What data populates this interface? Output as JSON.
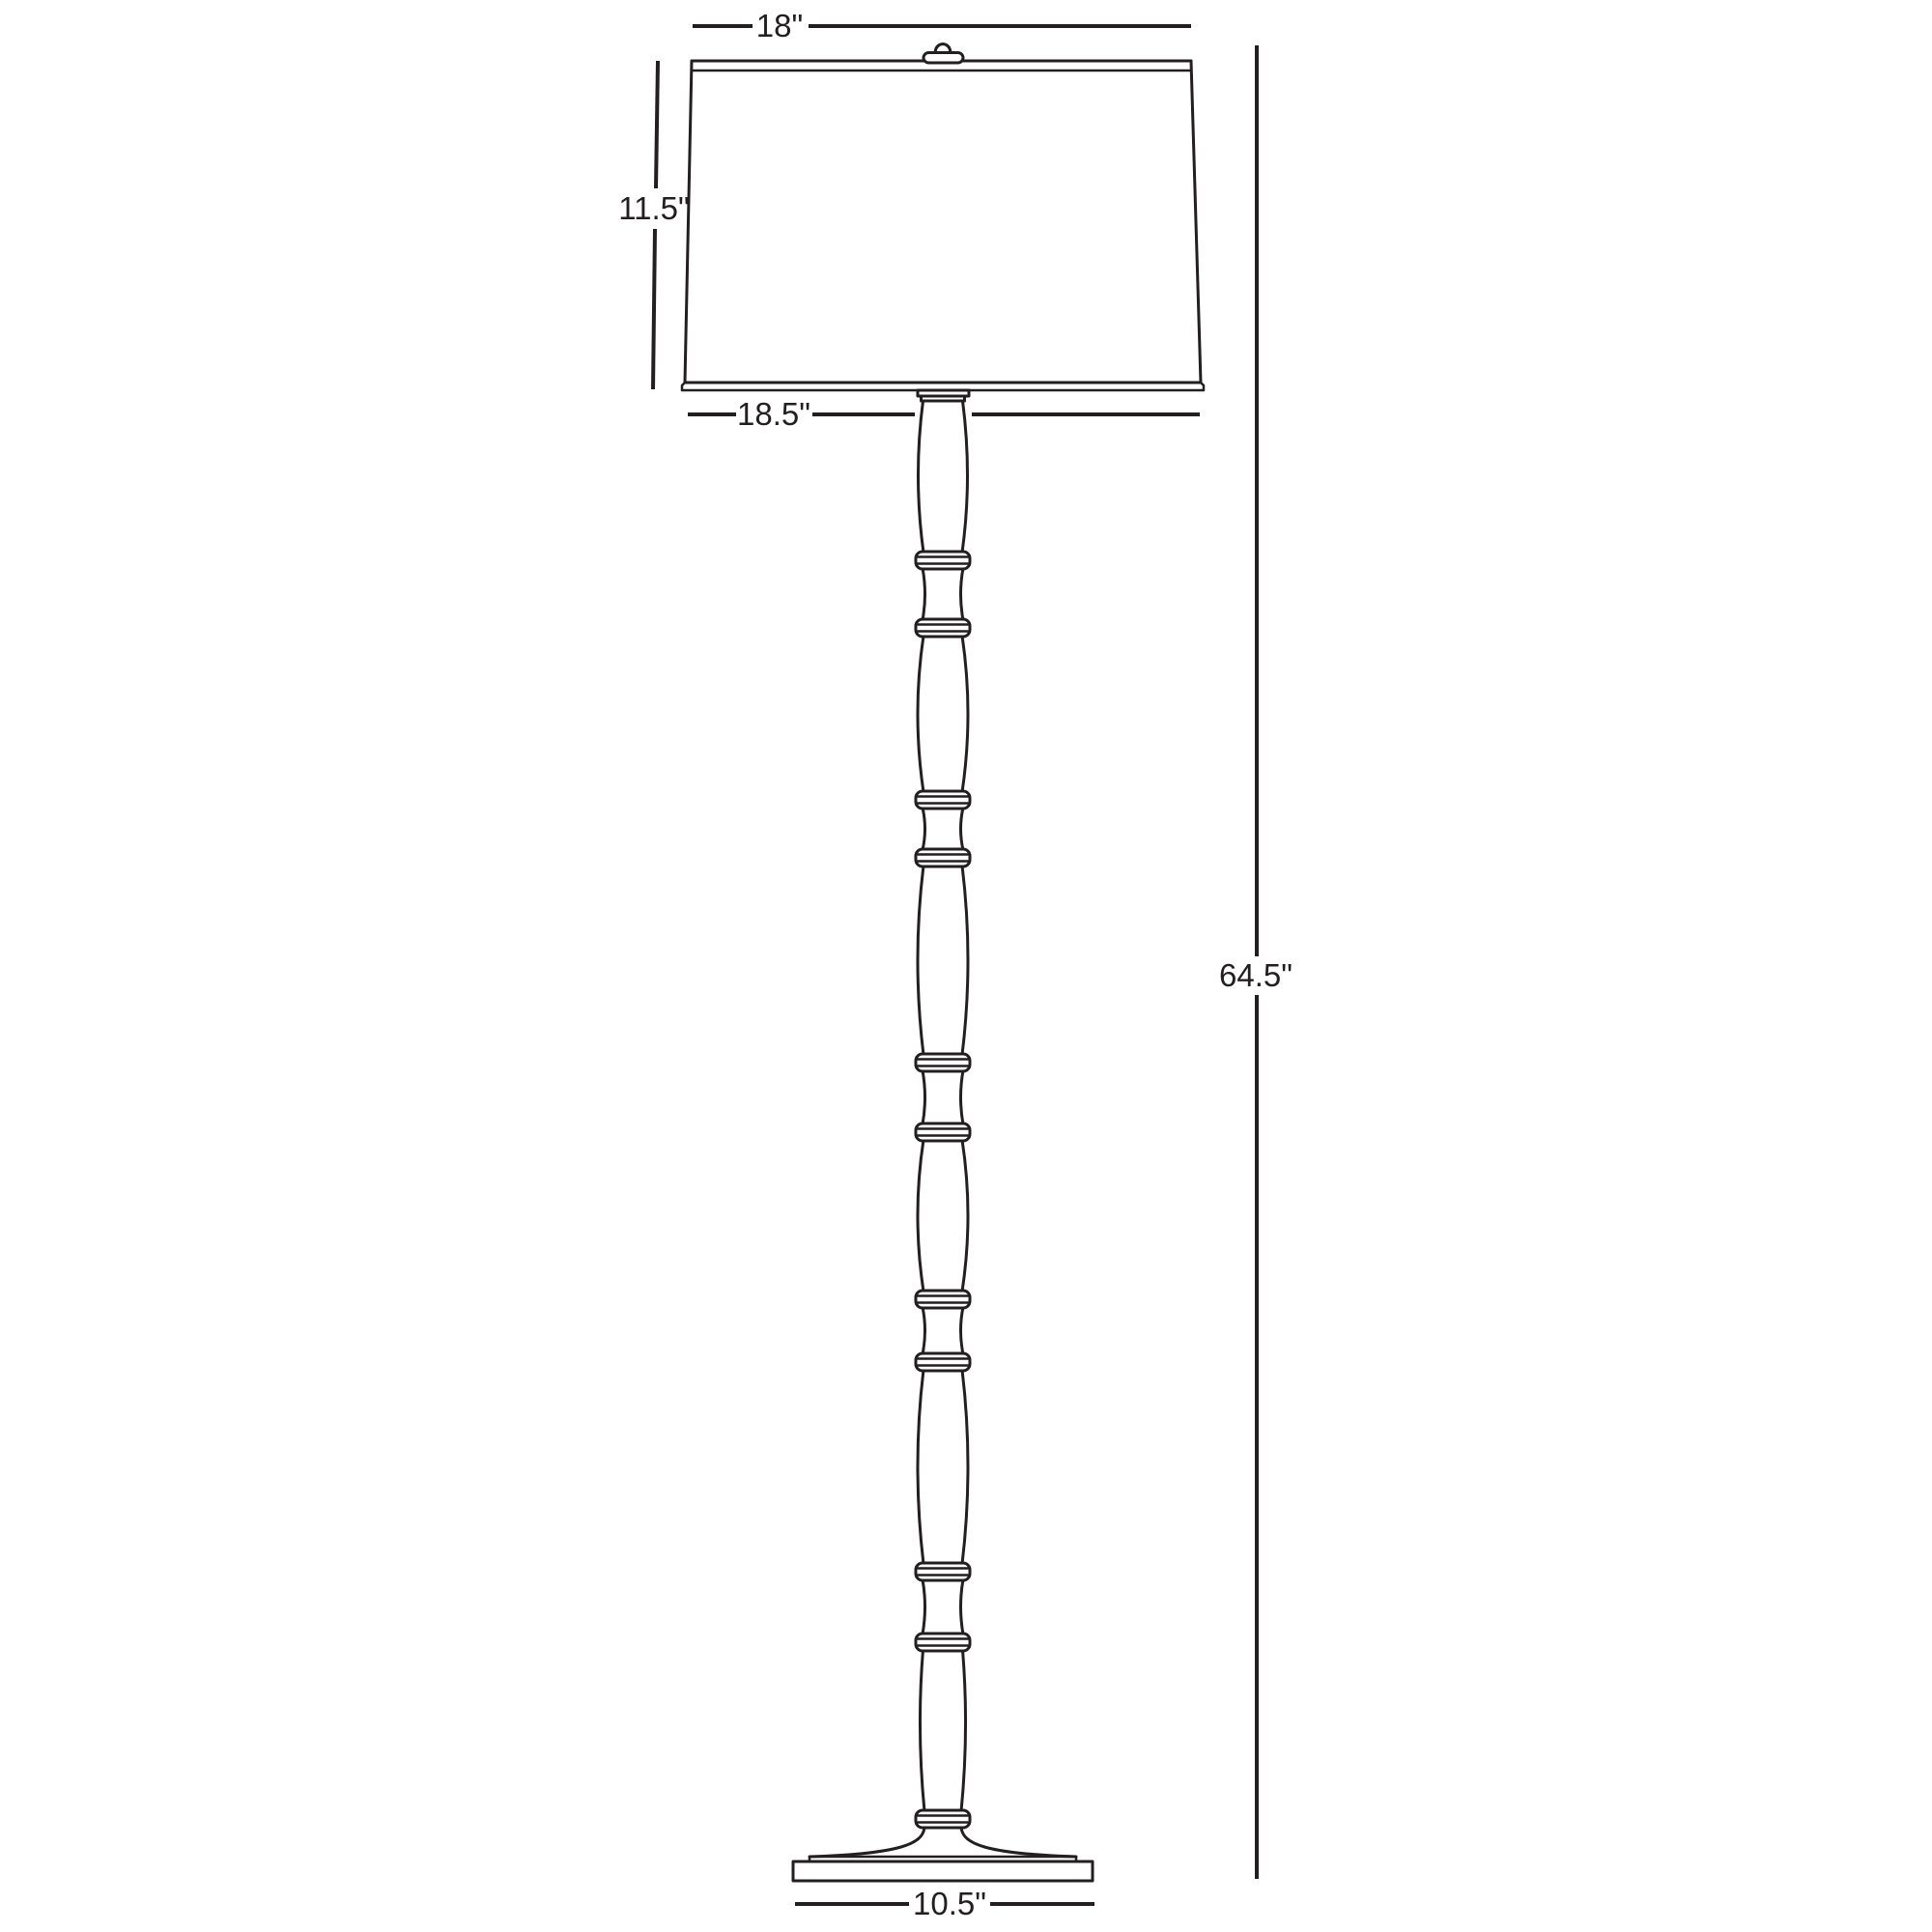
{
  "diagram": {
    "title": "Floor lamp dimension drawing",
    "background_color": "#ffffff",
    "line_color": "#231f20",
    "labels": {
      "shade_top_width": "18\"",
      "shade_height": "11.5\"",
      "shade_bottom_width": "18.5\"",
      "overall_height": "64.5\"",
      "base_width": "10.5\""
    }
  }
}
